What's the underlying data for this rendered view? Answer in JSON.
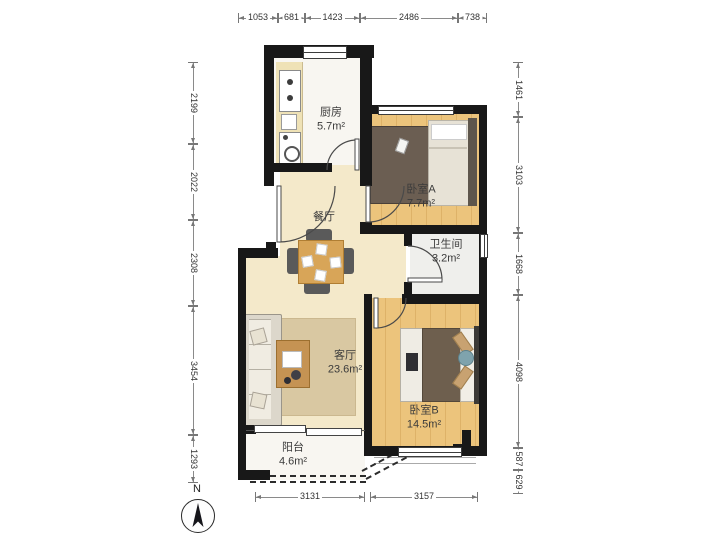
{
  "compass": {
    "north_label": "N"
  },
  "rooms": {
    "kitchen": {
      "name": "厨房",
      "area": "5.7m²"
    },
    "bedroom_a": {
      "name": "卧室A",
      "area": "7.7m²"
    },
    "dining": {
      "name": "餐厅"
    },
    "bathroom": {
      "name": "卫生间",
      "area": "3.2m²"
    },
    "living": {
      "name": "客厅",
      "area": "23.6m²"
    },
    "bedroom_b": {
      "name": "卧室B",
      "area": "14.5m²"
    },
    "balcony": {
      "name": "阳台",
      "area": "4.6m²"
    }
  },
  "dimensions": {
    "top": [
      "1053",
      "681",
      "1423",
      "2486",
      "738"
    ],
    "left": [
      "2199",
      "2022",
      "2308",
      "3454",
      "1293"
    ],
    "right": [
      "1461",
      "3103",
      "1668",
      "4098",
      "587",
      "629"
    ],
    "bottom": [
      "3131",
      "3157"
    ]
  },
  "colors": {
    "wall": "#181818",
    "floor_main": "#f4e9ca",
    "floor_wood": "#ecc47c",
    "floor_wet": "#efefec",
    "table_wood": "#d8a558"
  }
}
